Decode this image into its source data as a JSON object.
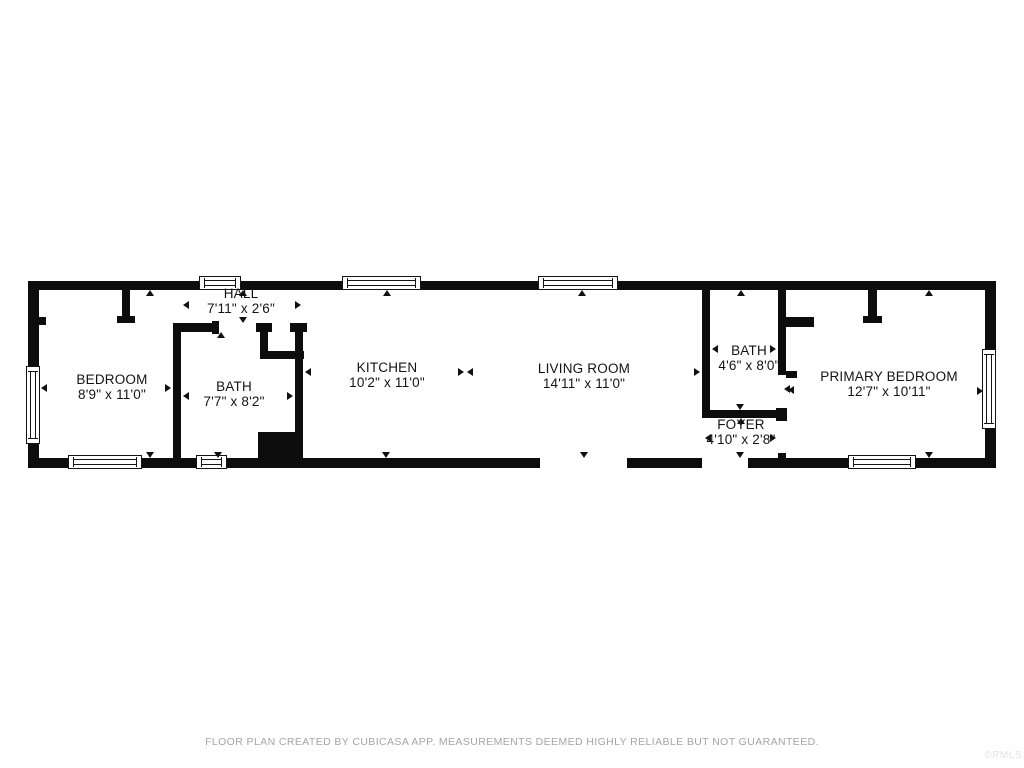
{
  "canvas": {
    "width": 1024,
    "height": 768,
    "background": "#ffffff",
    "wall_color": "#0d0d0d",
    "text_color": "#141414",
    "footer_color": "#a5a5a5"
  },
  "rooms": [
    {
      "name": "BEDROOM",
      "dims": "8'9\" x 11'0\"",
      "cx": 112,
      "y": 372
    },
    {
      "name": "HALL",
      "dims": "7'11\" x 2'6\"",
      "cx": 241,
      "y": 286
    },
    {
      "name": "BATH",
      "dims": "7'7\" x 8'2\"",
      "cx": 234,
      "y": 379
    },
    {
      "name": "KITCHEN",
      "dims": "10'2\" x 11'0\"",
      "cx": 387,
      "y": 360
    },
    {
      "name": "LIVING ROOM",
      "dims": "14'11\" x 11'0\"",
      "cx": 584,
      "y": 361
    },
    {
      "name": "BATH",
      "dims": "4'6\" x 8'0\"",
      "cx": 749,
      "y": 343
    },
    {
      "name": "FOYER",
      "dims": "4'10\" x 2'8\"",
      "cx": 741,
      "y": 417
    },
    {
      "name": "PRIMARY BEDROOM",
      "dims": "12'7\" x 10'11\"",
      "cx": 889,
      "y": 369
    }
  ],
  "plan": {
    "walls": [
      [
        28,
        281,
        968,
        9
      ],
      [
        28,
        458,
        968,
        10
      ],
      [
        28,
        281,
        11,
        187
      ],
      [
        985,
        281,
        11,
        187
      ],
      [
        122,
        290,
        8,
        27
      ],
      [
        117,
        316,
        18,
        7
      ],
      [
        39,
        317,
        7,
        8
      ],
      [
        173,
        323,
        8,
        135
      ],
      [
        173,
        323,
        45,
        9
      ],
      [
        212,
        321,
        7,
        13
      ],
      [
        256,
        323,
        16,
        9
      ],
      [
        260,
        323,
        8,
        36
      ],
      [
        260,
        351,
        44,
        8
      ],
      [
        290,
        323,
        17,
        9
      ],
      [
        295,
        323,
        8,
        109
      ],
      [
        258,
        432,
        45,
        26
      ],
      [
        702,
        290,
        8,
        128
      ],
      [
        778,
        290,
        8,
        85
      ],
      [
        786,
        317,
        28,
        10
      ],
      [
        786,
        371,
        11,
        7
      ],
      [
        702,
        410,
        84,
        8
      ],
      [
        776,
        408,
        11,
        13
      ],
      [
        778,
        453,
        8,
        7
      ],
      [
        868,
        290,
        9,
        27
      ],
      [
        863,
        316,
        19,
        7
      ]
    ],
    "door_openings": [
      [
        540,
        458,
        87,
        10
      ],
      [
        702,
        458,
        46,
        10
      ]
    ],
    "windows": [
      {
        "x": 199,
        "y": 276,
        "w": 42,
        "h": 14,
        "o": "h"
      },
      {
        "x": 342,
        "y": 276,
        "w": 79,
        "h": 14,
        "o": "h"
      },
      {
        "x": 538,
        "y": 276,
        "w": 80,
        "h": 14,
        "o": "h"
      },
      {
        "x": 68,
        "y": 455,
        "w": 74,
        "h": 14,
        "o": "h"
      },
      {
        "x": 196,
        "y": 455,
        "w": 31,
        "h": 14,
        "o": "h"
      },
      {
        "x": 848,
        "y": 455,
        "w": 68,
        "h": 14,
        "o": "h"
      },
      {
        "x": 26,
        "y": 366,
        "w": 14,
        "h": 78,
        "o": "v"
      },
      {
        "x": 982,
        "y": 349,
        "w": 14,
        "h": 80,
        "o": "v"
      }
    ],
    "arrows": [
      {
        "x": 150,
        "y": 290,
        "d": "up"
      },
      {
        "x": 150,
        "y": 458,
        "d": "down"
      },
      {
        "x": 41,
        "y": 388,
        "d": "left"
      },
      {
        "x": 171,
        "y": 388,
        "d": "right"
      },
      {
        "x": 183,
        "y": 305,
        "d": "left"
      },
      {
        "x": 301,
        "y": 305,
        "d": "right"
      },
      {
        "x": 243,
        "y": 290,
        "d": "up"
      },
      {
        "x": 243,
        "y": 323,
        "d": "down"
      },
      {
        "x": 221,
        "y": 332,
        "d": "up"
      },
      {
        "x": 218,
        "y": 458,
        "d": "down"
      },
      {
        "x": 183,
        "y": 396,
        "d": "left"
      },
      {
        "x": 293,
        "y": 396,
        "d": "right"
      },
      {
        "x": 387,
        "y": 290,
        "d": "up"
      },
      {
        "x": 386,
        "y": 458,
        "d": "down"
      },
      {
        "x": 305,
        "y": 372,
        "d": "left"
      },
      {
        "x": 464,
        "y": 372,
        "d": "right"
      },
      {
        "x": 467,
        "y": 372,
        "d": "left"
      },
      {
        "x": 582,
        "y": 290,
        "d": "up"
      },
      {
        "x": 584,
        "y": 458,
        "d": "down"
      },
      {
        "x": 700,
        "y": 372,
        "d": "right"
      },
      {
        "x": 741,
        "y": 290,
        "d": "up"
      },
      {
        "x": 740,
        "y": 410,
        "d": "down"
      },
      {
        "x": 712,
        "y": 349,
        "d": "left"
      },
      {
        "x": 776,
        "y": 349,
        "d": "right"
      },
      {
        "x": 784,
        "y": 389,
        "d": "left"
      },
      {
        "x": 741,
        "y": 418,
        "d": "up"
      },
      {
        "x": 740,
        "y": 458,
        "d": "down"
      },
      {
        "x": 705,
        "y": 438,
        "d": "left"
      },
      {
        "x": 776,
        "y": 438,
        "d": "right"
      },
      {
        "x": 929,
        "y": 290,
        "d": "up"
      },
      {
        "x": 929,
        "y": 458,
        "d": "down"
      },
      {
        "x": 788,
        "y": 390,
        "d": "left"
      },
      {
        "x": 983,
        "y": 391,
        "d": "right"
      }
    ]
  },
  "footer": {
    "disclaimer": "FLOOR PLAN CREATED BY CUBICASA APP. MEASUREMENTS DEEMED HIGHLY RELIABLE BUT NOT GUARANTEED.",
    "watermark": "©RMLS"
  }
}
